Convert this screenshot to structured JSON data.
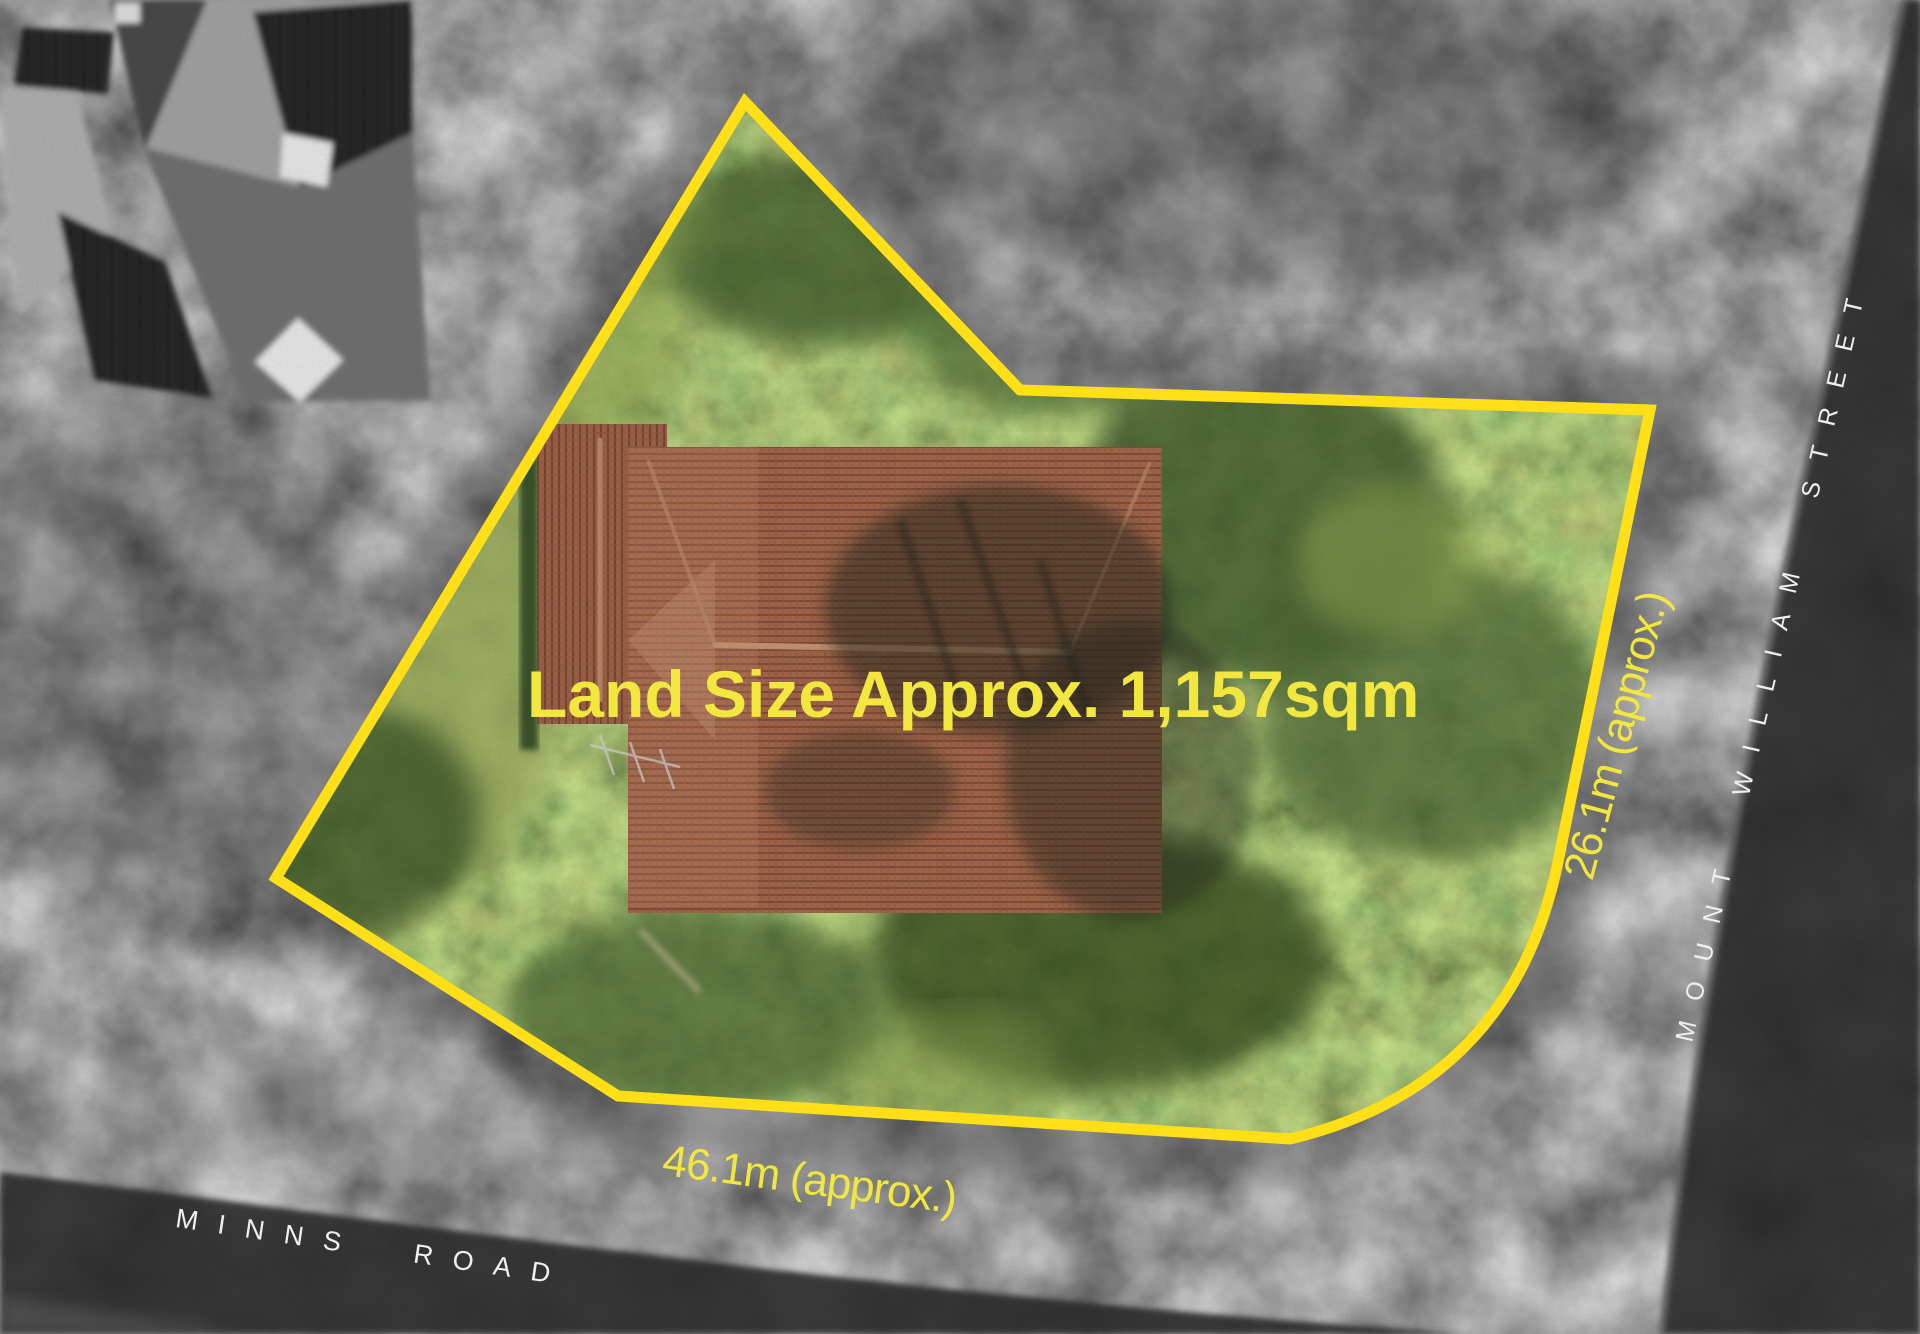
{
  "property": {
    "land_size_label": "Land Size Approx. 1,157sqm",
    "frontage_label": "46.1m (approx.)",
    "side_label": "26.1m (approx.)"
  },
  "streets": {
    "minns_road": "MINNS ROAD",
    "mount_william_street": "MOUNT WILLIAM STREET"
  },
  "colors": {
    "boundary": "#FFDF17",
    "dimension_text": "#F2E73E",
    "street_text": "#EFEFEF"
  }
}
